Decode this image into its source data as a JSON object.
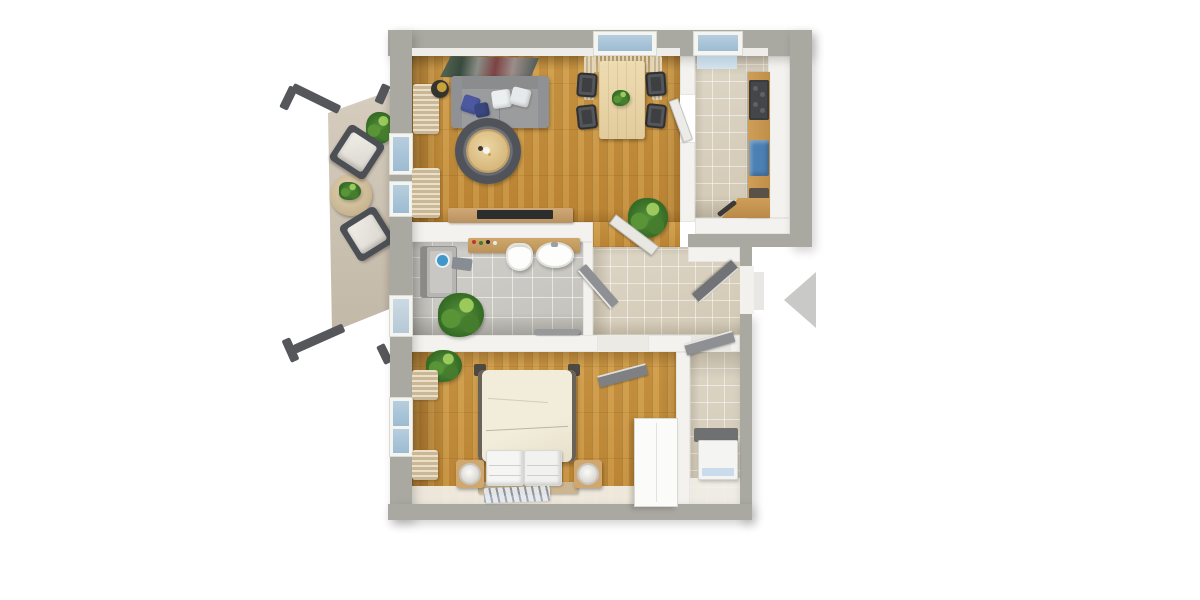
{
  "scene": {
    "title": "apartment-floor-plan-3d-top-view",
    "background_color": "#ffffff",
    "text_labels": "none"
  },
  "palette": {
    "wall_outer": "#a9a8a1",
    "wall_inner": "#f3f2ee",
    "wood_floor": "#c79140",
    "tile_beige": "#d8d0be",
    "tile_gray": "#cbc9c2",
    "balcony_floor": "#ccc2b2",
    "window_glass": "#a7c2d8",
    "sofa_gray": "#9b9c9e",
    "pillow_blue": "#4c59a0",
    "rug_dark": "#565a5f",
    "counter_wood": "#c99a55",
    "kitchen_sink_blue": "#4b80b4",
    "door_leaf_gray": "#85878a",
    "bed_cream": "#efe9d7",
    "plant_green": "#4e8f3a",
    "entrance_arrow": "#c9c9c7"
  },
  "rooms": {
    "living": {
      "label": "living-dining-room",
      "floor": "wood"
    },
    "kitchen": {
      "label": "kitchen",
      "floor": "beige-tile"
    },
    "bathroom": {
      "label": "bathroom",
      "floor": "gray-tile"
    },
    "hallway": {
      "label": "hallway",
      "floor": "beige-tile"
    },
    "bedroom": {
      "label": "bedroom",
      "floor": "wood"
    },
    "utility": {
      "label": "utility-storage-room",
      "floor": "beige-tile"
    },
    "balcony": {
      "label": "balcony-terrace",
      "floor": "stone"
    }
  },
  "furniture": {
    "sofa": "gray-sofa-with-pillows",
    "wall_art": "abstract-wall-picture",
    "coffee_table": "round-coffee-table-on-rug",
    "floor_lamp": "floor-lamp",
    "sideboard": "tv-sideboard",
    "dining_table": "dining-table-4-chairs",
    "kitchen_counter": "kitchen-counter-cooktop-sink",
    "shower": "walk-in-shower",
    "toilet": "toilet",
    "sink": "washbasin-vanity",
    "bed": "double-bed-with-nightstands",
    "wardrobe": "white-wardrobe",
    "washing_machine": "washing-machine",
    "balcony_chairs": "two-outdoor-armchairs",
    "balcony_table": "round-outdoor-table",
    "plants": "potted-plants"
  },
  "entrance": {
    "label": "entrance-direction-marker",
    "marker": "left-pointing-triangle",
    "color": "#c9c9c7"
  },
  "windows": {
    "glass_color": "#a7c2d8",
    "count_visible": 6
  }
}
